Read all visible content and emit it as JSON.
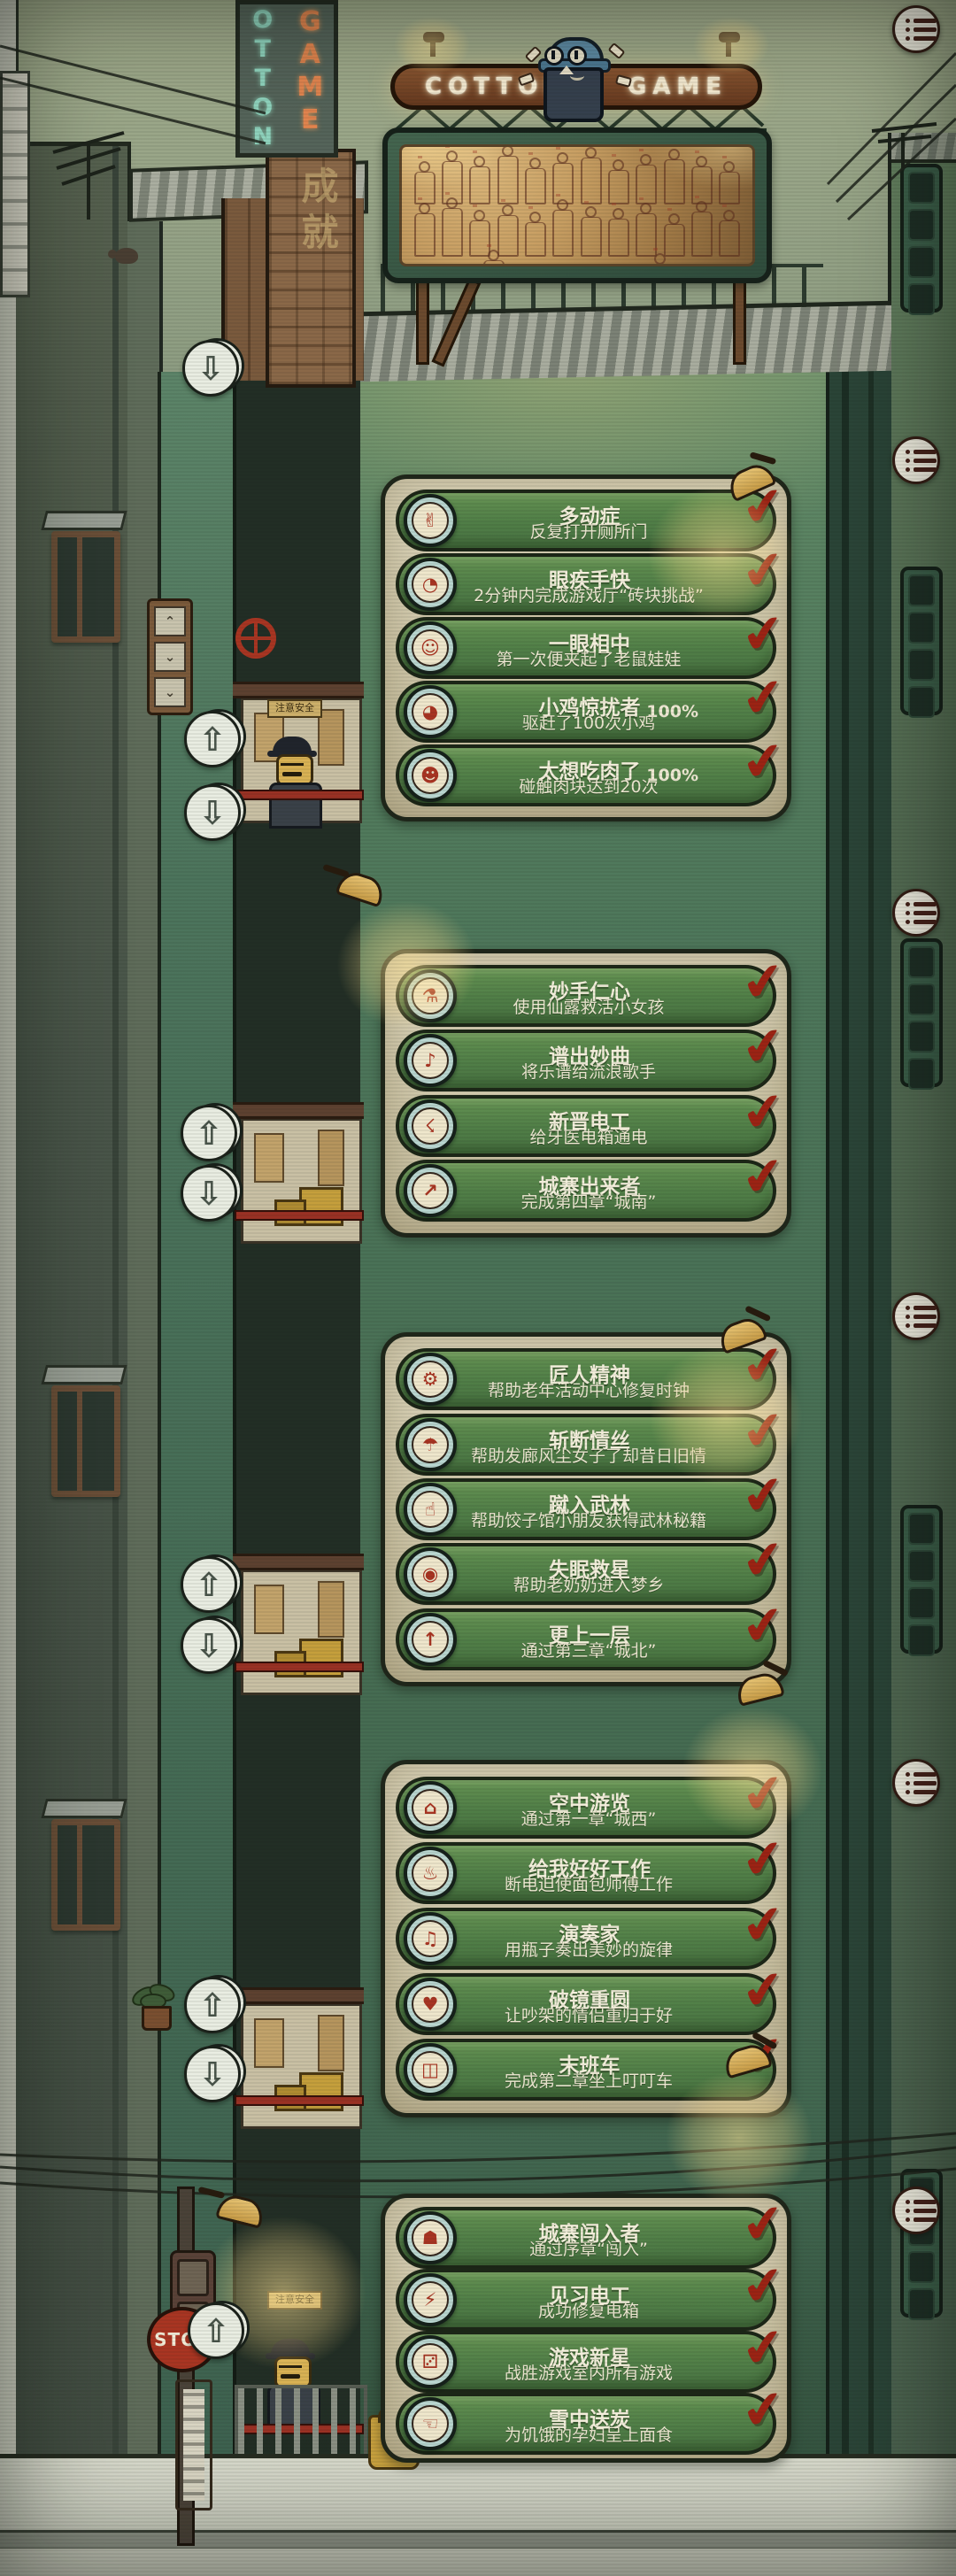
{
  "signs": {
    "neon_left": "COTTON",
    "neon_right": "GAME",
    "vertical_sign_col1": "OTTON",
    "vertical_sign_col2": "GAME",
    "chimney_text": "成就",
    "elevator_warning": "注意安全",
    "stop_sign": "STOP"
  },
  "ui": {
    "up_arrow": "⇧",
    "down_arrow": "⇩",
    "check": "✔",
    "menu_icon": "list-menu-icon"
  },
  "colors": {
    "achievement_bar_green": "#4f7d45",
    "panel_parchment": "#cdc5a7",
    "badge_ring_blue": "#b9d6d0",
    "badge_face_cream": "#efe7cc",
    "icon_red": "#a83422",
    "checkmark_red": "#9c2314",
    "text_cream": "#f4efdc",
    "lamp_glow": "#ffe496",
    "neon_board_brown": "#6b3f24"
  },
  "achievement_groups": [
    {
      "name": "group-1",
      "items": [
        {
          "icon": "glove-hand-icon",
          "glyph": "✌",
          "title": "多动症",
          "desc": "反复打开厕所门",
          "progress": "",
          "completed": true
        },
        {
          "icon": "stopwatch-icon",
          "glyph": "◔",
          "title": "眼疾手快",
          "desc": "2分钟内完成游戏厅“砖块挑战”",
          "progress": "",
          "completed": true
        },
        {
          "icon": "mouse-doll-icon",
          "glyph": "☺",
          "title": "一眼相中",
          "desc": "第一次便夹起了老鼠娃娃",
          "progress": "",
          "completed": true
        },
        {
          "icon": "chick-icon",
          "glyph": "◕",
          "title": "小鸡惊扰者",
          "desc": "驱赶了100次小鸡",
          "progress": "100%",
          "completed": true
        },
        {
          "icon": "meat-face-icon",
          "glyph": "☻",
          "title": "太想吃肉了",
          "desc": "碰触肉块达到20次",
          "progress": "100%",
          "completed": true
        }
      ]
    },
    {
      "name": "group-2",
      "items": [
        {
          "icon": "elixir-bottle-icon",
          "glyph": "⚗",
          "title": "妙手仁心",
          "desc": "使用仙露救活小女孩",
          "progress": "",
          "completed": true
        },
        {
          "icon": "music-score-icon",
          "glyph": "♪",
          "title": "谱出妙曲",
          "desc": "将乐谱给流浪歌手",
          "progress": "",
          "completed": true
        },
        {
          "icon": "helmet-bolt-icon",
          "glyph": "☇",
          "title": "新晋电工",
          "desc": "给牙医电箱通电",
          "progress": "",
          "completed": true
        },
        {
          "icon": "leg-out-icon",
          "glyph": "↗",
          "title": "城寨出来者",
          "desc": "完成第四章“城南”",
          "progress": "",
          "completed": true
        }
      ]
    },
    {
      "name": "group-3",
      "items": [
        {
          "icon": "gear-icon",
          "glyph": "⚙",
          "title": "匠人精神",
          "desc": "帮助老年活动中心修复时钟",
          "progress": "",
          "completed": true
        },
        {
          "icon": "umbrella-icon",
          "glyph": "☂",
          "title": "斩断情丝",
          "desc": "帮助发廊风尘女子了却昔日旧情",
          "progress": "",
          "completed": true
        },
        {
          "icon": "palm-icon",
          "glyph": "☝",
          "title": "蹴入武林",
          "desc": "帮助饺子馆小朋友获得武林秘籍",
          "progress": "",
          "completed": true
        },
        {
          "icon": "pill-icon",
          "glyph": "◉",
          "title": "失眠救星",
          "desc": "帮助老奶奶进入梦乡",
          "progress": "",
          "completed": true
        },
        {
          "icon": "up-arrow-icon",
          "glyph": "↑",
          "title": "更上一层",
          "desc": "通过第三章“城北”",
          "progress": "",
          "completed": true
        }
      ]
    },
    {
      "name": "group-4",
      "items": [
        {
          "icon": "cable-car-icon",
          "glyph": "⌂",
          "title": "空中游览",
          "desc": "通过第一章“城西”",
          "progress": "",
          "completed": true
        },
        {
          "icon": "baker-icon",
          "glyph": "♨",
          "title": "给我好好工作",
          "desc": "断电迫使面包师傅工作",
          "progress": "",
          "completed": true
        },
        {
          "icon": "bottle-music-icon",
          "glyph": "♫",
          "title": "演奏家",
          "desc": "用瓶子奏出美妙的旋律",
          "progress": "",
          "completed": true
        },
        {
          "icon": "bandaged-heart-icon",
          "glyph": "♥",
          "title": "破镜重圆",
          "desc": "让吵架的情侣重归于好",
          "progress": "",
          "completed": true
        },
        {
          "icon": "tram-icon",
          "glyph": "◫",
          "title": "末班车",
          "desc": "完成第二章坐上叮叮车",
          "progress": "",
          "completed": true
        }
      ]
    },
    {
      "name": "group-5",
      "items": [
        {
          "icon": "boot-icon",
          "glyph": "☗",
          "title": "城寨闯入者",
          "desc": "通过序章“闯入”",
          "progress": "",
          "completed": true
        },
        {
          "icon": "lightning-icon",
          "glyph": "⚡",
          "title": "见习电工",
          "desc": "成功修复电箱",
          "progress": "",
          "completed": true
        },
        {
          "icon": "gamepad-icon",
          "glyph": "⚂",
          "title": "游戏新星",
          "desc": "战胜游戏室内所有游戏",
          "progress": "",
          "completed": true
        },
        {
          "icon": "giving-hand-icon",
          "glyph": "☜",
          "title": "雪中送炭",
          "desc": "为饥饿的孕妇呈上面食",
          "progress": "",
          "completed": true
        }
      ]
    }
  ]
}
